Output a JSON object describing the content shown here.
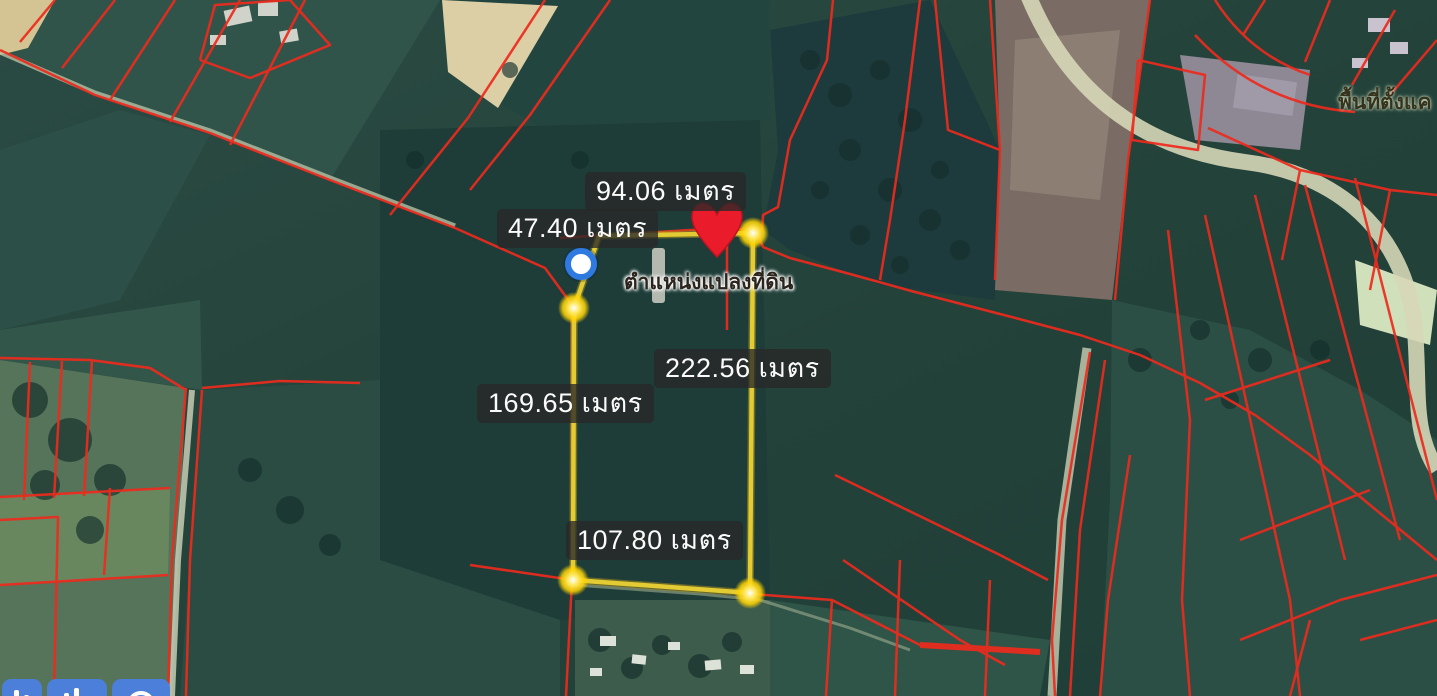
{
  "map": {
    "place_label": "พื้นที่ตั้งแค",
    "marker_label": "ตำแหน่งแปลงที่ดิน",
    "measurements": {
      "top": {
        "value": "94.06",
        "unit": "เมตร",
        "text": "94.06 เมตร"
      },
      "upper_left": {
        "value": "47.40",
        "unit": "เมตร",
        "text": "47.40 เมตร"
      },
      "right": {
        "value": "222.56",
        "unit": "เมตร",
        "text": "222.56 เมตร"
      },
      "left": {
        "value": "169.65",
        "unit": "เมตร",
        "text": "169.65 เมตร"
      },
      "bottom": {
        "value": "107.80",
        "unit": "เมตร",
        "text": "107.80 เมตร"
      }
    },
    "colors": {
      "parcel_outline": "#e2cb33",
      "cadastral_line": "#ee2a1d",
      "pin": "#ea1c2c",
      "active_vertex_ring": "#2f7ae0",
      "vertex_fill": "#ffd900",
      "chip_background": "rgba(40,40,40,0.78)",
      "chip_text": "#fbfbfb",
      "action_button_blue": "#4b7fd9"
    }
  },
  "toolbar": {
    "buttons": [
      {
        "icon": "bar-chart-icon"
      },
      {
        "icon": "bar-chart-icon"
      },
      {
        "icon": "circle-icon"
      }
    ]
  }
}
